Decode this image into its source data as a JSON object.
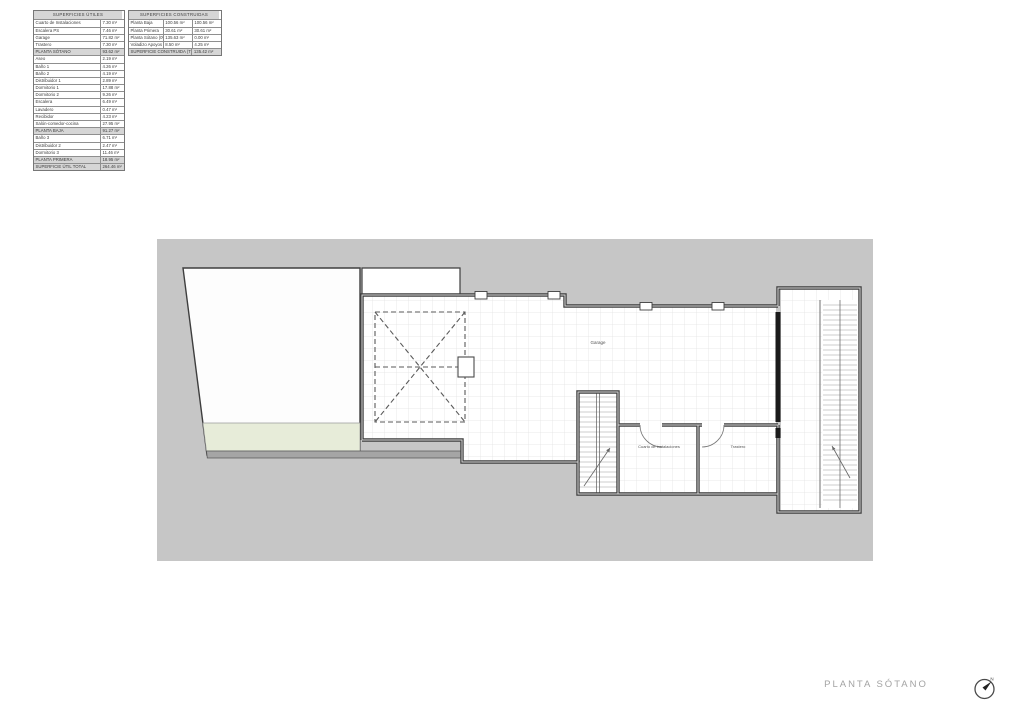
{
  "footer": {
    "title": "PLANTA SÓTANO"
  },
  "colors": {
    "site_gray": "#c6c6c6",
    "wall_dark": "#3e3e3e",
    "tile_line": "#e3e3e3",
    "green_strip": "#e7ecd9",
    "table_shade": "#d6d6d6",
    "title_gray": "#a3a3a3"
  },
  "tables": {
    "utiles": {
      "title": "SUPERFICIES ÚTILES",
      "rows": [
        {
          "label": "Cuarto de Instalaciones",
          "value": "7.30 m²",
          "type": "data"
        },
        {
          "label": "Escalera PS",
          "value": "7.46 m²",
          "type": "data"
        },
        {
          "label": "Garage",
          "value": "71.82 m²",
          "type": "data"
        },
        {
          "label": "Trastero",
          "value": "7.30 m²",
          "type": "data"
        },
        {
          "label": "PLANTA SÓTANO",
          "value": "93.62 m²",
          "type": "subtotal"
        },
        {
          "label": "Aseo",
          "value": "2.19 m²",
          "type": "data"
        },
        {
          "label": "Baño 1",
          "value": "4.26 m²",
          "type": "data"
        },
        {
          "label": "Baño 2",
          "value": "4.19 m²",
          "type": "data"
        },
        {
          "label": "Distribuidor 1",
          "value": "2.89 m²",
          "type": "data"
        },
        {
          "label": "Dormitorio 1",
          "value": "17.88 m²",
          "type": "data"
        },
        {
          "label": "Dormitorio 2",
          "value": "9.26 m²",
          "type": "data"
        },
        {
          "label": "Escalera",
          "value": "6.49 m²",
          "type": "data"
        },
        {
          "label": "Lavadero",
          "value": "0.47 m²",
          "type": "data"
        },
        {
          "label": "Recibidor",
          "value": "4.23 m²",
          "type": "data"
        },
        {
          "label": "Salón-comedor-cocina",
          "value": "27.95 m²",
          "type": "data"
        },
        {
          "label": "PLANTA BAJA",
          "value": "91.27 m²",
          "type": "subtotal"
        },
        {
          "label": "Baño 3",
          "value": "6.71 m²",
          "type": "data"
        },
        {
          "label": "Distribuidor 2",
          "value": "2.47 m²",
          "type": "data"
        },
        {
          "label": "Dormitorio 3",
          "value": "11.46 m²",
          "type": "data"
        },
        {
          "label": "PLANTA PRIMERA",
          "value": "18.95 m²",
          "type": "subtotal"
        },
        {
          "label": "SUPERFICIE ÚTIL TOTAL",
          "value": "264.46 m²",
          "type": "total"
        }
      ]
    },
    "construidas": {
      "title": "SUPERFICIES CONSTRUIDAS",
      "rows": [
        {
          "label": "Planta Baja",
          "v1": "100.56 m²",
          "v2": "100.56 m²",
          "type": "data"
        },
        {
          "label": "Planta Primera",
          "v1": "30.61 m²",
          "v2": "30.61 m²",
          "type": "data"
        },
        {
          "label": "Planta Sótano (0%)",
          "v1": "135.63 m²",
          "v2": "0.00 m²",
          "type": "data"
        },
        {
          "label": "Voladizo Apoyos (50%)",
          "v1": "8.50 m²",
          "v2": "4.25 m²",
          "type": "data"
        },
        {
          "label": "SUPERFICIE CONSTRUIDA (TOTAL)",
          "v1": "",
          "v2": "135.42 m²",
          "type": "total"
        }
      ]
    }
  },
  "plan": {
    "rooms": [
      {
        "label": "Garage"
      },
      {
        "label": "Cuarto de instalaciones"
      },
      {
        "label": "Trastero"
      }
    ],
    "compass": {
      "letter": "N"
    }
  }
}
